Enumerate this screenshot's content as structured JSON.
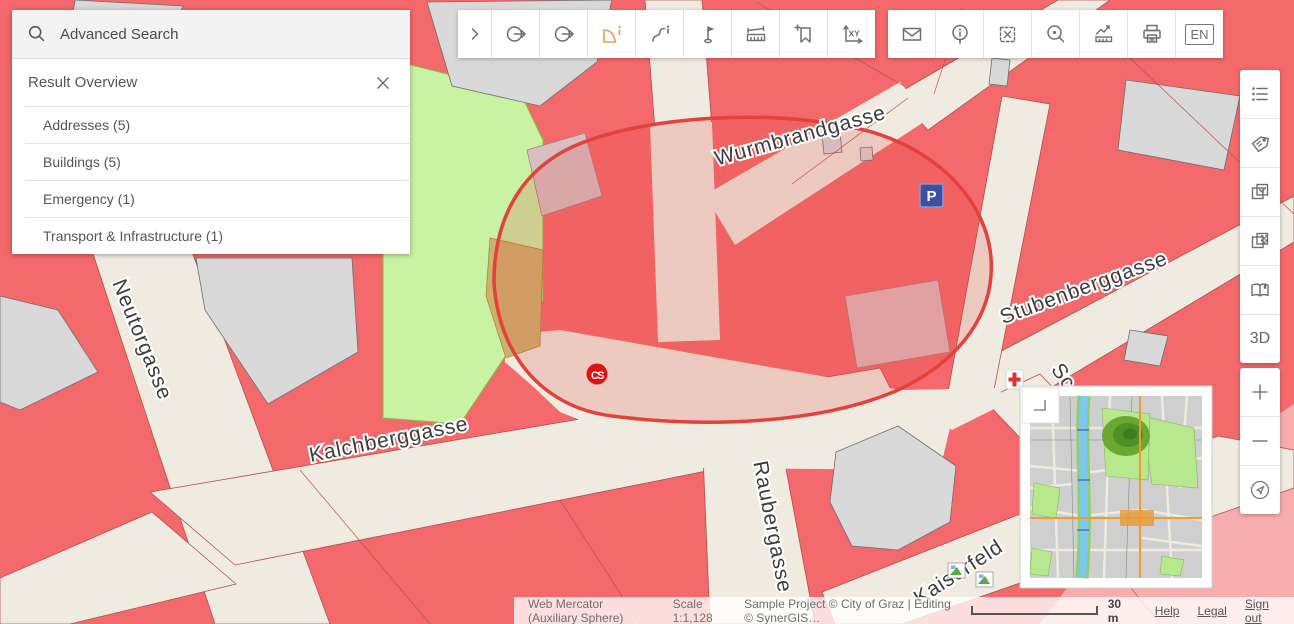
{
  "search_panel": {
    "placeholder": "Advanced Search",
    "result_overview_title": "Result Overview",
    "categories": [
      {
        "label": "Addresses (5)"
      },
      {
        "label": "Buildings (5)"
      },
      {
        "label": "Emergency (1)"
      },
      {
        "label": "Transport & Infrastructure (1)"
      }
    ]
  },
  "toolbar_main": {
    "icons": [
      "expand-chevron",
      "previous-extent",
      "next-extent",
      "identify-area",
      "identify-line",
      "place-marker",
      "measure",
      "add-bookmark",
      "coordinates-xy"
    ],
    "active_tool": "identify-area"
  },
  "toolbar_secondary": {
    "icons": [
      "mail",
      "info",
      "clear-selection",
      "zoom-to-selection",
      "profile",
      "print",
      "language"
    ],
    "language_label": "EN"
  },
  "sidebar_right": {
    "icons": [
      "legend-list",
      "label-tag",
      "select-layers",
      "basemap-transparency",
      "map-book"
    ],
    "threed_label": "3D"
  },
  "zoom_controls": {
    "icons": [
      "zoom-in",
      "zoom-out",
      "locate"
    ]
  },
  "map": {
    "street_labels": [
      {
        "text": "Wurmbrandgasse"
      },
      {
        "text": "Stubenberggasse"
      },
      {
        "text": "Neutorgasse"
      },
      {
        "text": "Kalchberggasse"
      },
      {
        "text": "Raubergasse"
      },
      {
        "text": "Kaiserfeld"
      },
      {
        "text": "Sc"
      }
    ],
    "markers": {
      "parking_label": "P",
      "cs_label": "CS"
    }
  },
  "statusbar": {
    "projection": "Web Mercator (Auxiliary Sphere)",
    "scale": "Scale 1:1,128",
    "copyright": "Sample Project © City of Graz | Editing © SynerGIS…",
    "scalebar_label": "30 m",
    "links": [
      {
        "label": "Help"
      },
      {
        "label": "Legal"
      },
      {
        "label": "Sign out"
      }
    ]
  },
  "colors": {
    "accent_active_tool": "#e89b4a",
    "selection_outline": "#e2413c",
    "building_red": "#f4696b",
    "park_green": "#c9f2a2",
    "parking_blue": "#3d4fa1",
    "street_cream": "#efebe0"
  }
}
